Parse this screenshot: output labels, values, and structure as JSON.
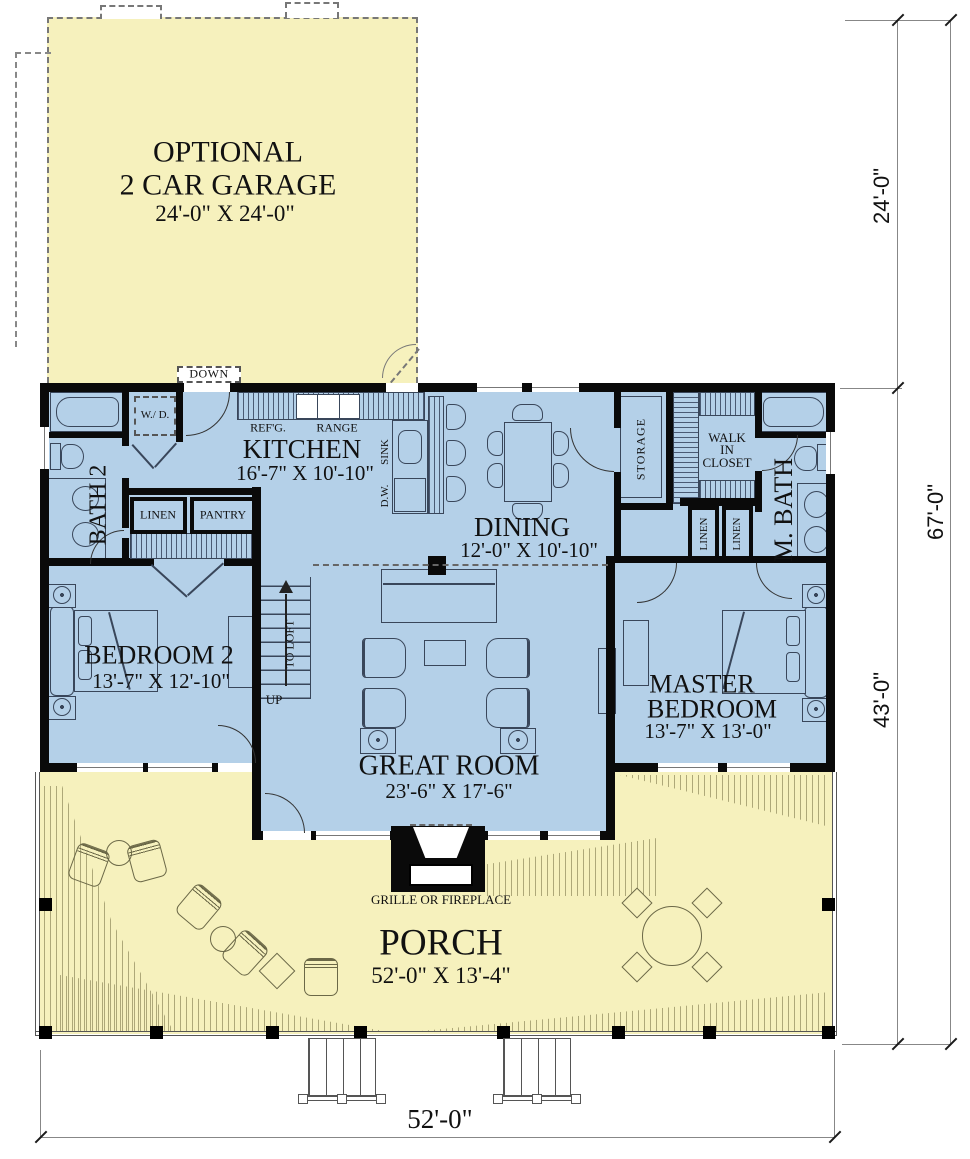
{
  "plan_type": "first-floor plan with optional garage",
  "colors": {
    "interior_fill": "#b4d0e8",
    "exterior_fill": "#f6f1bd",
    "wall": "#0a0a0a"
  },
  "rooms": {
    "garage": {
      "title_line1": "OPTIONAL",
      "title_line2": "2 CAR GARAGE",
      "dims": "24'-0\" X 24'-0\"",
      "down": "DOWN"
    },
    "kitchen": {
      "name": "KITCHEN",
      "dims": "16'-7\" X 10'-10\"",
      "refg": "REF'G.",
      "range": "RANGE",
      "sink": "SINK",
      "dw": "D.W."
    },
    "dining": {
      "name": "DINING",
      "dims": "12'-0\" X 10'-10\""
    },
    "great_room": {
      "name": "GREAT ROOM",
      "dims": "23'-6\" X 17'-6\""
    },
    "bedroom2": {
      "name": "BEDROOM 2",
      "dims": "13'-7\" X 12'-10\""
    },
    "master": {
      "line1": "MASTER",
      "line2": "BEDROOM",
      "dims": "13'-7\" X 13'-0\""
    },
    "porch": {
      "name": "PORCH",
      "dims": "52'-0\" X 13'-4\"",
      "grille": "GRILLE OR FIREPLACE"
    },
    "bath2": {
      "name": "BATH 2"
    },
    "mbath": {
      "name": "M. BATH"
    },
    "wic": {
      "line1": "WALK",
      "line2": "IN",
      "line3": "CLOSET"
    },
    "storage": {
      "name": "STORAGE"
    },
    "closets": {
      "linen_hall": "LINEN",
      "pantry": "PANTRY",
      "linen_a": "LINEN",
      "linen_b": "LINEN"
    },
    "laundry": {
      "wd": "W./ D."
    },
    "stairs": {
      "to_loft": "TO LOFT",
      "up": "UP"
    }
  },
  "dimensions": {
    "right_garage": "24'-0\"",
    "right_total": "67'-0\"",
    "right_house": "43'-0\"",
    "bottom": "52'-0\""
  }
}
